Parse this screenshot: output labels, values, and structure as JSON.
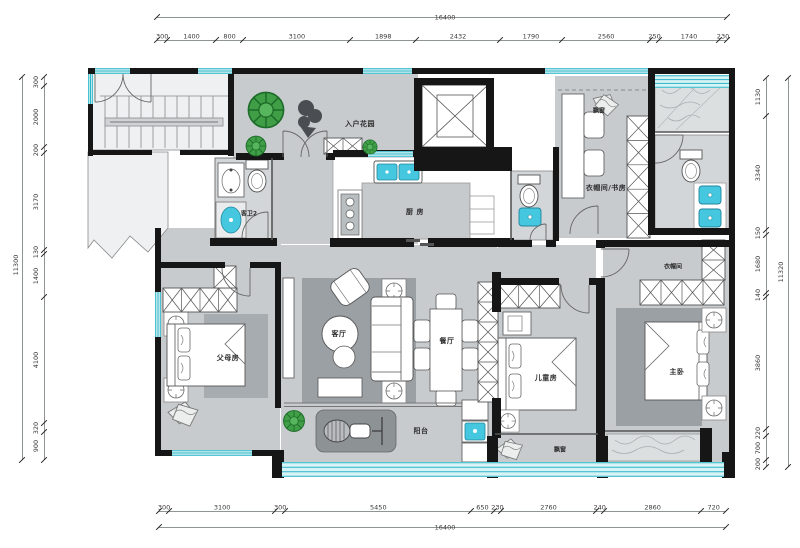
{
  "drawing_title": "residential floor plan",
  "rooms": {
    "entry_garden": "入户花园",
    "kitchen": "厨 房",
    "guest_bath2": "客卫2",
    "study_bay": "飘窗",
    "study": "衣帽间/书房",
    "closet": "衣帽间",
    "living": "客厅",
    "dining": "餐厅",
    "parents": "父母房",
    "kids": "儿童房",
    "master": "主卧",
    "balcony": "阳台",
    "bay_window": "飘窗"
  },
  "dimensions": {
    "top": {
      "total": "16400",
      "segments": [
        "300",
        "1400",
        "800",
        "3100",
        "1898",
        "2432",
        "1790",
        "2560",
        "250",
        "1740",
        "230"
      ]
    },
    "bottom": {
      "total": "16400",
      "segments": [
        "300",
        "3100",
        "300",
        "5450",
        "650",
        "230",
        "2760",
        "240",
        "2860",
        "720"
      ]
    },
    "left": {
      "total": "11300",
      "segments": [
        "300",
        "2000",
        "200",
        "3170",
        "130",
        "1400",
        "4100",
        "320",
        "900"
      ]
    },
    "right": {
      "total": "11320",
      "segments": [
        "1130",
        "3340",
        "150",
        "1680",
        "140",
        "3860",
        "220",
        "700",
        "200"
      ]
    }
  },
  "colors": {
    "wall": "#161616",
    "window_teal": "#2ab5c6",
    "window_fill": "#d8f3f6",
    "floor_gray": "#c7cbce",
    "rug_gray": "#9aa0a4",
    "fixture_cyan": "#45c7e0",
    "plant_green": "#3f9e46"
  }
}
